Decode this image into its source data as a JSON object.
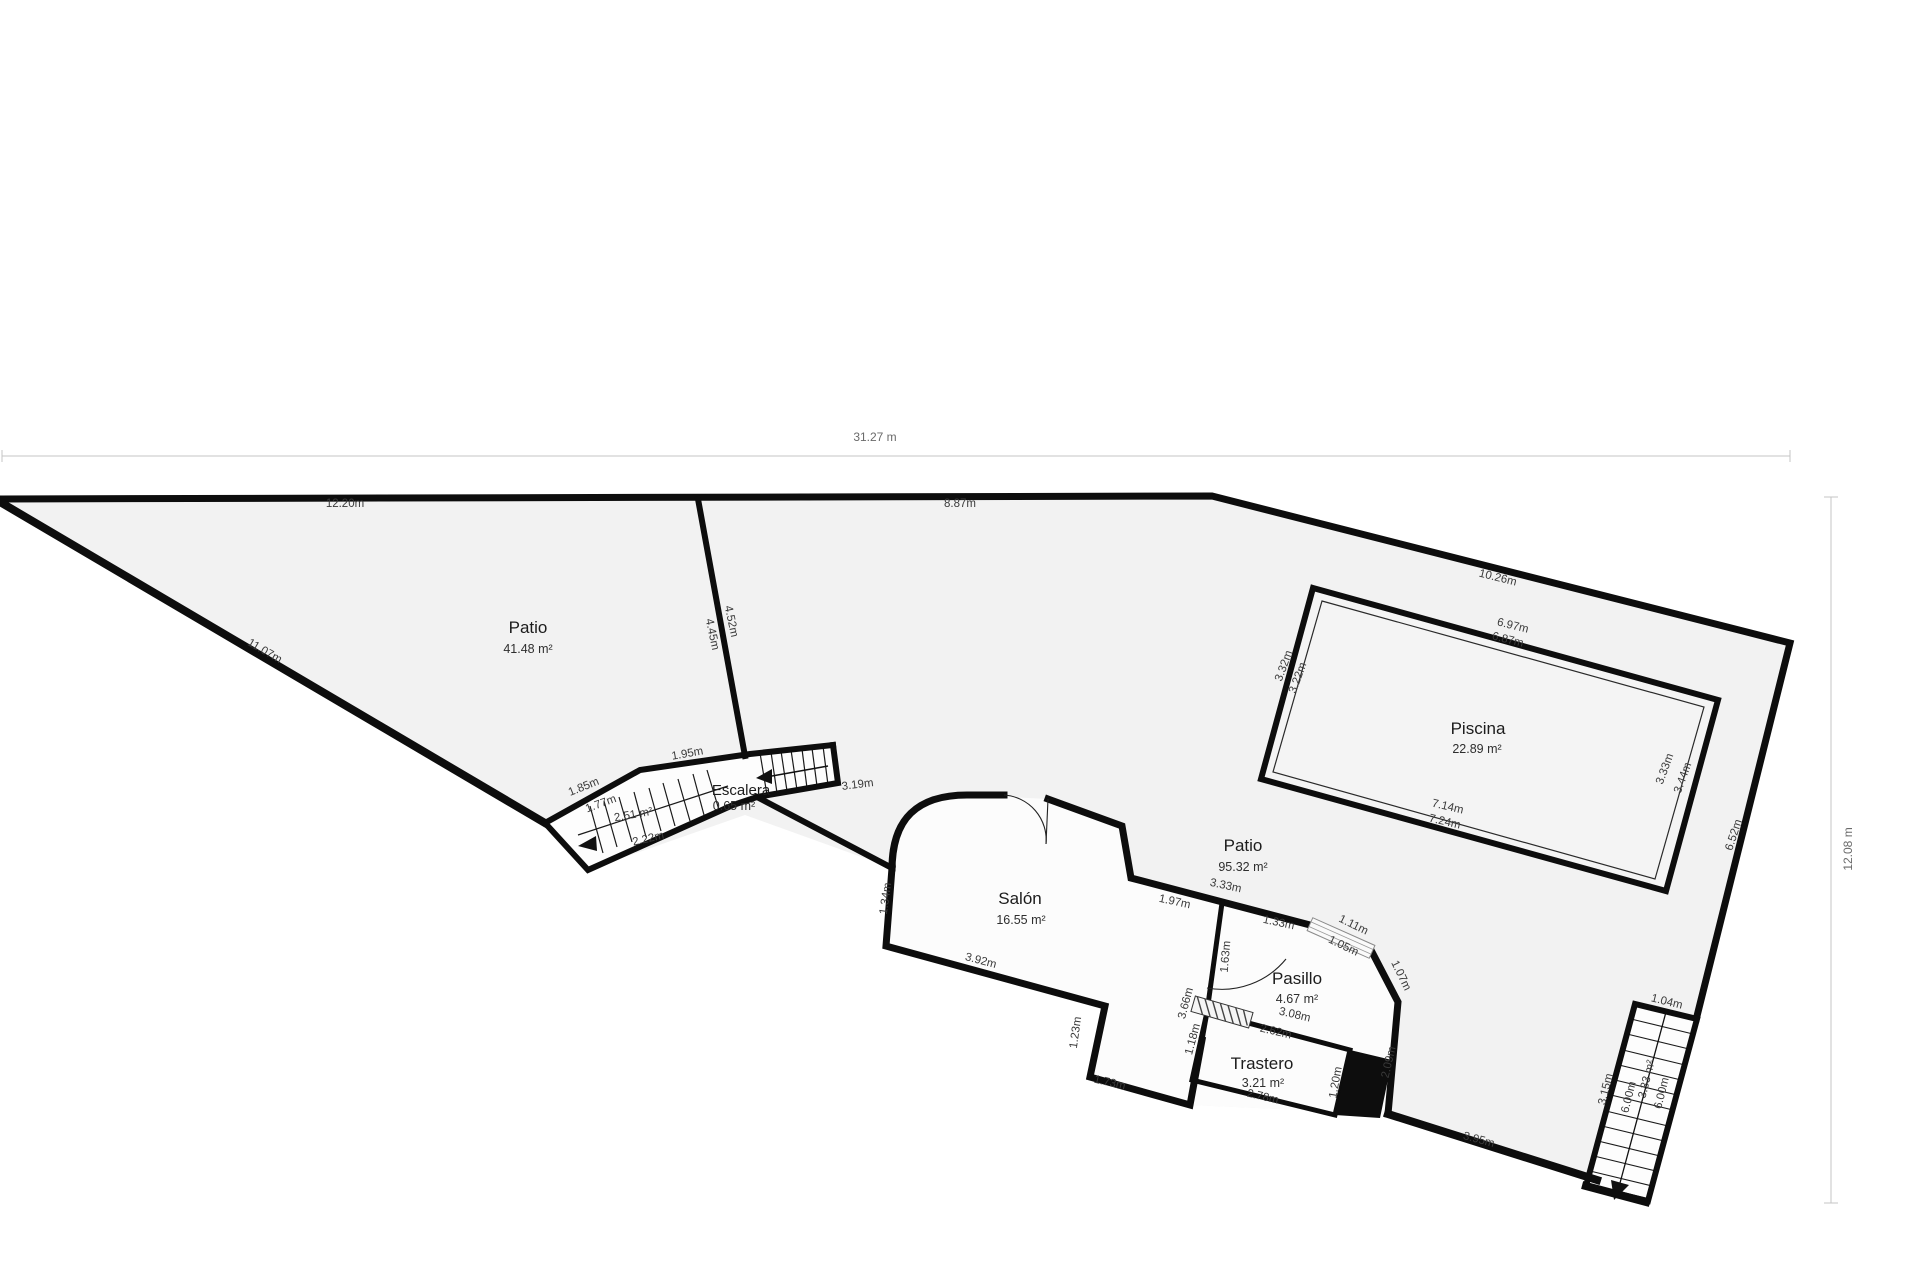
{
  "plan": {
    "type": "floor-plan",
    "overall_dimensions": {
      "width_label": "31.27 m",
      "height_label": "12.08 m"
    },
    "colors": {
      "wall": "#0d0d0d",
      "parcel_fill": "#f2f2f2",
      "room_fill": "#fcfcfc",
      "pool_fill": "#f4f4f4",
      "dim_line": "#c4c4c4",
      "label_text": "#3a3a3a"
    }
  },
  "rooms": [
    {
      "name": "Patio",
      "area": "41.48 m²"
    },
    {
      "name": "Piscina",
      "area": "22.89 m²"
    },
    {
      "name": "Patio",
      "area": "95.32 m²"
    },
    {
      "name": "Salón",
      "area": "16.55 m²"
    },
    {
      "name": "Pasillo",
      "area": "4.67 m²"
    },
    {
      "name": "Trastero",
      "area": "3.21 m²"
    },
    {
      "name": "Escalera",
      "area": "0.65 m²"
    }
  ],
  "measurements": [
    {
      "t": "12.20m"
    },
    {
      "t": "8.87m"
    },
    {
      "t": "11.07m"
    },
    {
      "t": "4.52m"
    },
    {
      "t": "4.45m"
    },
    {
      "t": "1.95m"
    },
    {
      "t": "1.85m"
    },
    {
      "t": "1.77m"
    },
    {
      "t": "2.51 m²"
    },
    {
      "t": "2.22m"
    },
    {
      "t": "3.19m"
    },
    {
      "t": "10.26m"
    },
    {
      "t": "6.97m"
    },
    {
      "t": "6.87m"
    },
    {
      "t": "3.32m"
    },
    {
      "t": "3.22m"
    },
    {
      "t": "3.33m"
    },
    {
      "t": "3.44m"
    },
    {
      "t": "7.14m"
    },
    {
      "t": "7.24m"
    },
    {
      "t": "6.52m"
    },
    {
      "t": "1.34m"
    },
    {
      "t": "3.92m"
    },
    {
      "t": "1.97m"
    },
    {
      "t": "3.33m"
    },
    {
      "t": "1.33m"
    },
    {
      "t": "1.11m"
    },
    {
      "t": "1.05m"
    },
    {
      "t": "1.07m"
    },
    {
      "t": "1.63m"
    },
    {
      "t": "3.08m"
    },
    {
      "t": "2.62m"
    },
    {
      "t": "2.78m"
    },
    {
      "t": "3.66m"
    },
    {
      "t": "1.18m"
    },
    {
      "t": "1.23m"
    },
    {
      "t": "1.73m"
    },
    {
      "t": "1.20m"
    },
    {
      "t": "2.09m"
    },
    {
      "t": "1.04m"
    },
    {
      "t": "3.15m"
    },
    {
      "t": "6.00m"
    },
    {
      "t": "3.33 m²"
    },
    {
      "t": "6.00m"
    },
    {
      "t": "3.95m"
    }
  ]
}
